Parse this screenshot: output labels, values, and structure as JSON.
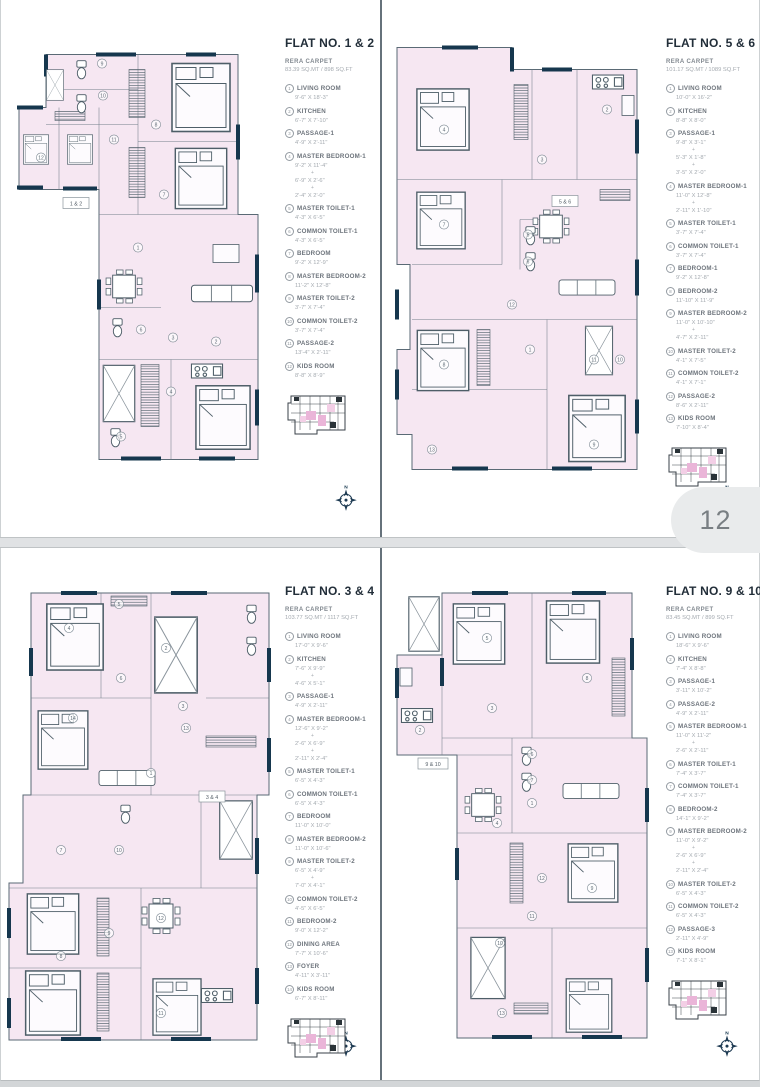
{
  "viewer": {
    "page_number": "12"
  },
  "plus_sign": "+",
  "panels": [
    {
      "title": "FLAT NO. 1 & 2",
      "rera_label": "RERA CARPET",
      "rera_value": "83.39 SQ.MT / 898 SQ.FT",
      "plan_label": "1 & 2",
      "compass": "N",
      "rooms": [
        {
          "num": "1",
          "name": "LIVING ROOM",
          "dims": [
            "9'-6\" X 18'-3\""
          ]
        },
        {
          "num": "2",
          "name": "KITCHEN",
          "dims": [
            "6'-7\" X 7'-10\""
          ]
        },
        {
          "num": "3",
          "name": "PASSAGE-1",
          "dims": [
            "4'-9\" X 2'-11\""
          ]
        },
        {
          "num": "4",
          "name": "MASTER BEDROOM-1",
          "dims": [
            "9'-2\" X 11'-4\"",
            "6'-9\" X 2'-6\"",
            "2'-4\" X 2'-0\""
          ]
        },
        {
          "num": "5",
          "name": "MASTER TOILET-1",
          "dims": [
            "4'-3\" X 6'-5\""
          ]
        },
        {
          "num": "6",
          "name": "COMMON TOILET-1",
          "dims": [
            "4'-3\" X 6'-5\""
          ]
        },
        {
          "num": "7",
          "name": "BEDROOM",
          "dims": [
            "9'-2\" X 12'-9\""
          ]
        },
        {
          "num": "8",
          "name": "MASTER BEDROOM-2",
          "dims": [
            "11'-2\" X 12'-8\""
          ]
        },
        {
          "num": "9",
          "name": "MASTER TOILET-2",
          "dims": [
            "3'-7\" X 7'-4\""
          ]
        },
        {
          "num": "10",
          "name": "COMMON TOILET-2",
          "dims": [
            "3'-7\" X 7'-4\""
          ]
        },
        {
          "num": "11",
          "name": "PASSAGE-2",
          "dims": [
            "13'-4\" X 2'-11\""
          ]
        },
        {
          "num": "12",
          "name": "KIDS ROOM",
          "dims": [
            "8'-8\" X 8'-9\""
          ]
        }
      ]
    },
    {
      "title": "FLAT NO. 5 & 6",
      "rera_label": "RERA CARPET",
      "rera_value": "101.17 SQ.MT / 1089 SQ.FT",
      "plan_label": "5 & 6",
      "compass": "N",
      "rooms": [
        {
          "num": "1",
          "name": "LIVING ROOM",
          "dims": [
            "10'-0\" X 16'-2\""
          ]
        },
        {
          "num": "2",
          "name": "KITCHEN",
          "dims": [
            "8'-8\" X 8'-0\""
          ]
        },
        {
          "num": "3",
          "name": "PASSAGE-1",
          "dims": [
            "9'-8\" X 3'-1\"",
            "5'-3\" X 1'-8\"",
            "3'-5\" X 2'-0\""
          ]
        },
        {
          "num": "4",
          "name": "MASTER BEDROOM-1",
          "dims": [
            "11'-0\" X 12'-8\"",
            "2'-11\" X 1'-10\""
          ]
        },
        {
          "num": "5",
          "name": "MASTER TOILET-1",
          "dims": [
            "3'-7\" X 7'-4\""
          ]
        },
        {
          "num": "6",
          "name": "COMMON TOILET-1",
          "dims": [
            "3'-7\" X 7'-4\""
          ]
        },
        {
          "num": "7",
          "name": "BEDROOM-1",
          "dims": [
            "9'-2\" X 12'-8\""
          ]
        },
        {
          "num": "8",
          "name": "BEDROOM-2",
          "dims": [
            "11'-10\" X 11'-9\""
          ]
        },
        {
          "num": "9",
          "name": "MASTER BEDROOM-2",
          "dims": [
            "11'-0\" X 10'-10\"",
            "4'-7\" X 2'-11\""
          ]
        },
        {
          "num": "10",
          "name": "MASTER TOILET-2",
          "dims": [
            "4'-1\" X 7'-5\""
          ]
        },
        {
          "num": "11",
          "name": "COMMON TOILET-2",
          "dims": [
            "4'-1\" X 7'-1\""
          ]
        },
        {
          "num": "12",
          "name": "PASSAGE-2",
          "dims": [
            "8'-6\" X 2'-11\""
          ]
        },
        {
          "num": "13",
          "name": "KIDS ROOM",
          "dims": [
            "7'-10\" X 8'-4\""
          ]
        }
      ]
    },
    {
      "title": "FLAT NO. 3 & 4",
      "rera_label": "RERA CARPET",
      "rera_value": "103.77 SQ.MT / 1117 SQ.FT",
      "plan_label": "3 & 4",
      "compass": "N",
      "rooms": [
        {
          "num": "1",
          "name": "LIVING ROOM",
          "dims": [
            "17'-0\" X 9'-6\""
          ]
        },
        {
          "num": "2",
          "name": "KITCHEN",
          "dims": [
            "7'-6\" X 9'-9\"",
            "4'-6\" X 5'-1\""
          ]
        },
        {
          "num": "3",
          "name": "PASSAGE-1",
          "dims": [
            "4'-9\" X 2'-11\""
          ]
        },
        {
          "num": "4",
          "name": "MASTER BEDROOM-1",
          "dims": [
            "12'-6\" X 9'-2\"",
            "2'-6\" X 6'-9\"",
            "2'-11\" X 2'-4\""
          ]
        },
        {
          "num": "5",
          "name": "MASTER TOILET-1",
          "dims": [
            "6'-5\" X 4'-3\""
          ]
        },
        {
          "num": "6",
          "name": "COMMON TOILET-1",
          "dims": [
            "6'-5\" X 4'-3\""
          ]
        },
        {
          "num": "7",
          "name": "BEDROOM",
          "dims": [
            "11'-0\" X 10'-0\""
          ]
        },
        {
          "num": "8",
          "name": "MASTER BEDROOM-2",
          "dims": [
            "11'-0\" X 10'-6\""
          ]
        },
        {
          "num": "9",
          "name": "MASTER TOILET-2",
          "dims": [
            "6'-5\" X 4'-9\"",
            "7'-0\" X 4'-1\""
          ]
        },
        {
          "num": "10",
          "name": "COMMON TOILET-2",
          "dims": [
            "4'-5\" X 6'-5\""
          ]
        },
        {
          "num": "11",
          "name": "BEDROOM-2",
          "dims": [
            "9'-0\" X 12'-2\""
          ]
        },
        {
          "num": "12",
          "name": "DINING AREA",
          "dims": [
            "7'-7\" X 10'-6\""
          ]
        },
        {
          "num": "13",
          "name": "FOYER",
          "dims": [
            "4'-11\" X 3'-11\""
          ]
        },
        {
          "num": "14",
          "name": "KIDS ROOM",
          "dims": [
            "6'-7\" X 8'-11\""
          ]
        }
      ]
    },
    {
      "title": "FLAT NO. 9 & 10",
      "rera_label": "RERA CARPET",
      "rera_value": "83.45 SQ.MT / 899 SQ.FT",
      "plan_label": "9 & 10",
      "compass": "N",
      "rooms": [
        {
          "num": "1",
          "name": "LIVING ROOM",
          "dims": [
            "18'-6\" X 9'-6\""
          ]
        },
        {
          "num": "2",
          "name": "KITCHEN",
          "dims": [
            "7'-4\" X 8'-8\""
          ]
        },
        {
          "num": "3",
          "name": "PASSAGE-1",
          "dims": [
            "3'-11\" X 10'-2\""
          ]
        },
        {
          "num": "4",
          "name": "PASSAGE-2",
          "dims": [
            "4'-9\" X 2'-11\""
          ]
        },
        {
          "num": "5",
          "name": "MASTER BEDROOM-1",
          "dims": [
            "11'-0\" X 11'-2\"",
            "2'-6\" X 2'-11\""
          ]
        },
        {
          "num": "6",
          "name": "MASTER TOILET-1",
          "dims": [
            "7'-4\" X 3'-7\""
          ]
        },
        {
          "num": "7",
          "name": "COMMON TOILET-1",
          "dims": [
            "7'-4\" X 3'-7\""
          ]
        },
        {
          "num": "8",
          "name": "BEDROOM-2",
          "dims": [
            "14'-1\" X 9'-2\""
          ]
        },
        {
          "num": "9",
          "name": "MASTER BEDROOM-2",
          "dims": [
            "11'-0\" X 9'-2\"",
            "2'-6\" X 6'-9\"",
            "2'-11\" X 2'-4\""
          ]
        },
        {
          "num": "10",
          "name": "MASTER TOILET-2",
          "dims": [
            "6'-5\" X 4'-3\""
          ]
        },
        {
          "num": "11",
          "name": "COMMON TOILET-2",
          "dims": [
            "6'-5\" X 4'-3\""
          ]
        },
        {
          "num": "12",
          "name": "PASSAGE-3",
          "dims": [
            "2'-11\" X 4'-9\""
          ]
        },
        {
          "num": "13",
          "name": "KIDS ROOM",
          "dims": [
            "7'-1\" X 8'-1\""
          ]
        }
      ]
    }
  ]
}
